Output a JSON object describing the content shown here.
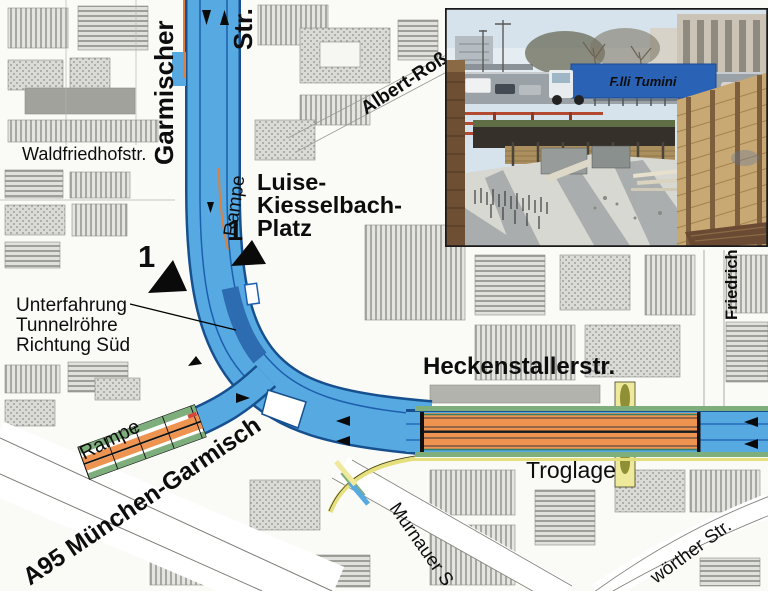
{
  "map": {
    "labels": {
      "garmischer": "Garmischer",
      "str_top": "Str.",
      "waldfriedhofstr": "Waldfriedhofstr.",
      "rampe_north": "Rampe",
      "albert_ross": "Albert-Roß",
      "luise": [
        "Luise-",
        "Kiesselbach-",
        "Platz"
      ],
      "unterfahrung": [
        "Unterfahrung",
        "Tunnelröhre",
        "Richtung Süd"
      ],
      "heckenstaller": "Heckenstallerstr.",
      "troglage": "Troglage",
      "friedrich": "Friedrich",
      "rampe_south": "Rampe",
      "a95": "A95 München-Garmisch",
      "murnauer": "Murnauer S",
      "woerther": "wörther Str.",
      "marker_1a": "1",
      "marker_1b": "1"
    },
    "colors": {
      "road_blue": "#57a9e1",
      "road_blue_dark": "#17508f",
      "tunnel_dark_blue": "#2d6cb0",
      "tunnel_orange": "#ee9350",
      "ramp_green": "#7fae7d",
      "minor_yellow": "#efe99c"
    }
  },
  "inset": {
    "truck_text": "F.lli Tumini",
    "colors": {
      "truck_blue": "#2a62b5",
      "car_red": "#c13a2e"
    }
  }
}
